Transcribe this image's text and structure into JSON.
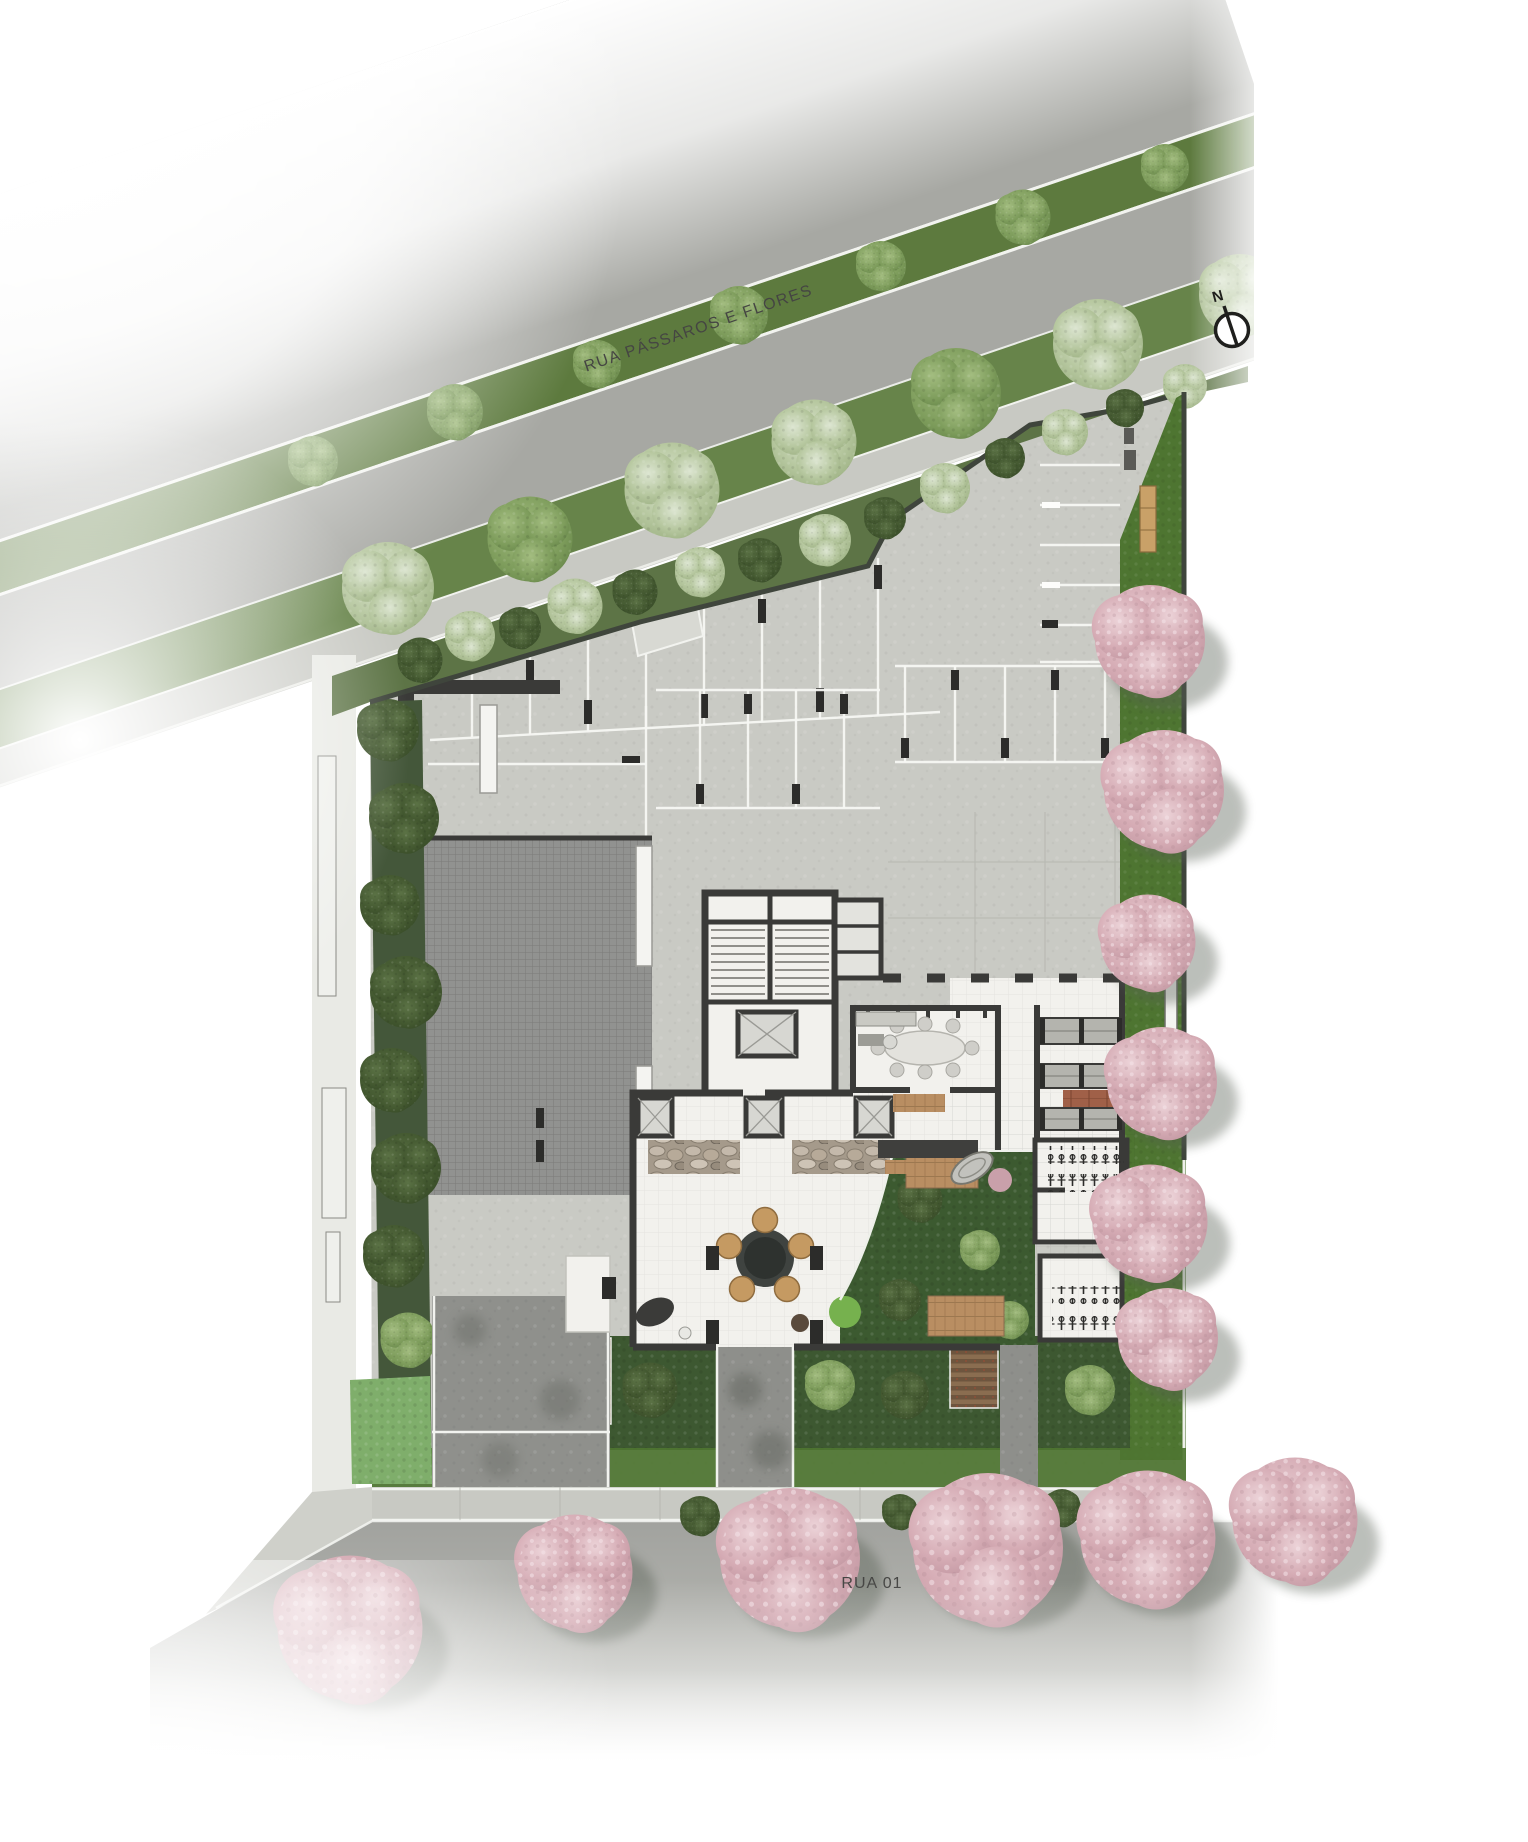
{
  "plan": {
    "streets": {
      "top": {
        "label": "RUA PÁSSAROS E FLORES"
      },
      "bottom": {
        "label": "RUA 01"
      }
    },
    "compass": {
      "label": "N"
    },
    "palette": {
      "road": "#a7a8a3",
      "road_low": "#a1a29e",
      "sidewalk": "#c8c9c3",
      "concrete": "#c9cac4",
      "hedge": "#5d7446",
      "verge": "#67844a",
      "median": "#5d7a3e",
      "lawn": "#4e7531",
      "leaf_dark": "#3a4f2c",
      "leaf_mid": "#5e7f43",
      "leaf_pale": "#93ab77",
      "bloom": "#cdd9bc",
      "pink": "#c79aa4",
      "pink_light": "#e7c9cf",
      "wall": "#3a3a38",
      "floor": "#f2f1ed",
      "wood": "#b98e62",
      "brick": "#a06048",
      "stone": "#b3a596",
      "ramp": "#919290",
      "drive": "#8f908c",
      "path": "#8e8f8b",
      "bed_brown": "#7d6248",
      "stall_line": "#f7f7f3",
      "tickc": "#2c2c2a",
      "bench_wood": "#c9a168",
      "furn_tan": "#c59a62",
      "label": "#454543",
      "compass": "#1f1f1d"
    }
  }
}
